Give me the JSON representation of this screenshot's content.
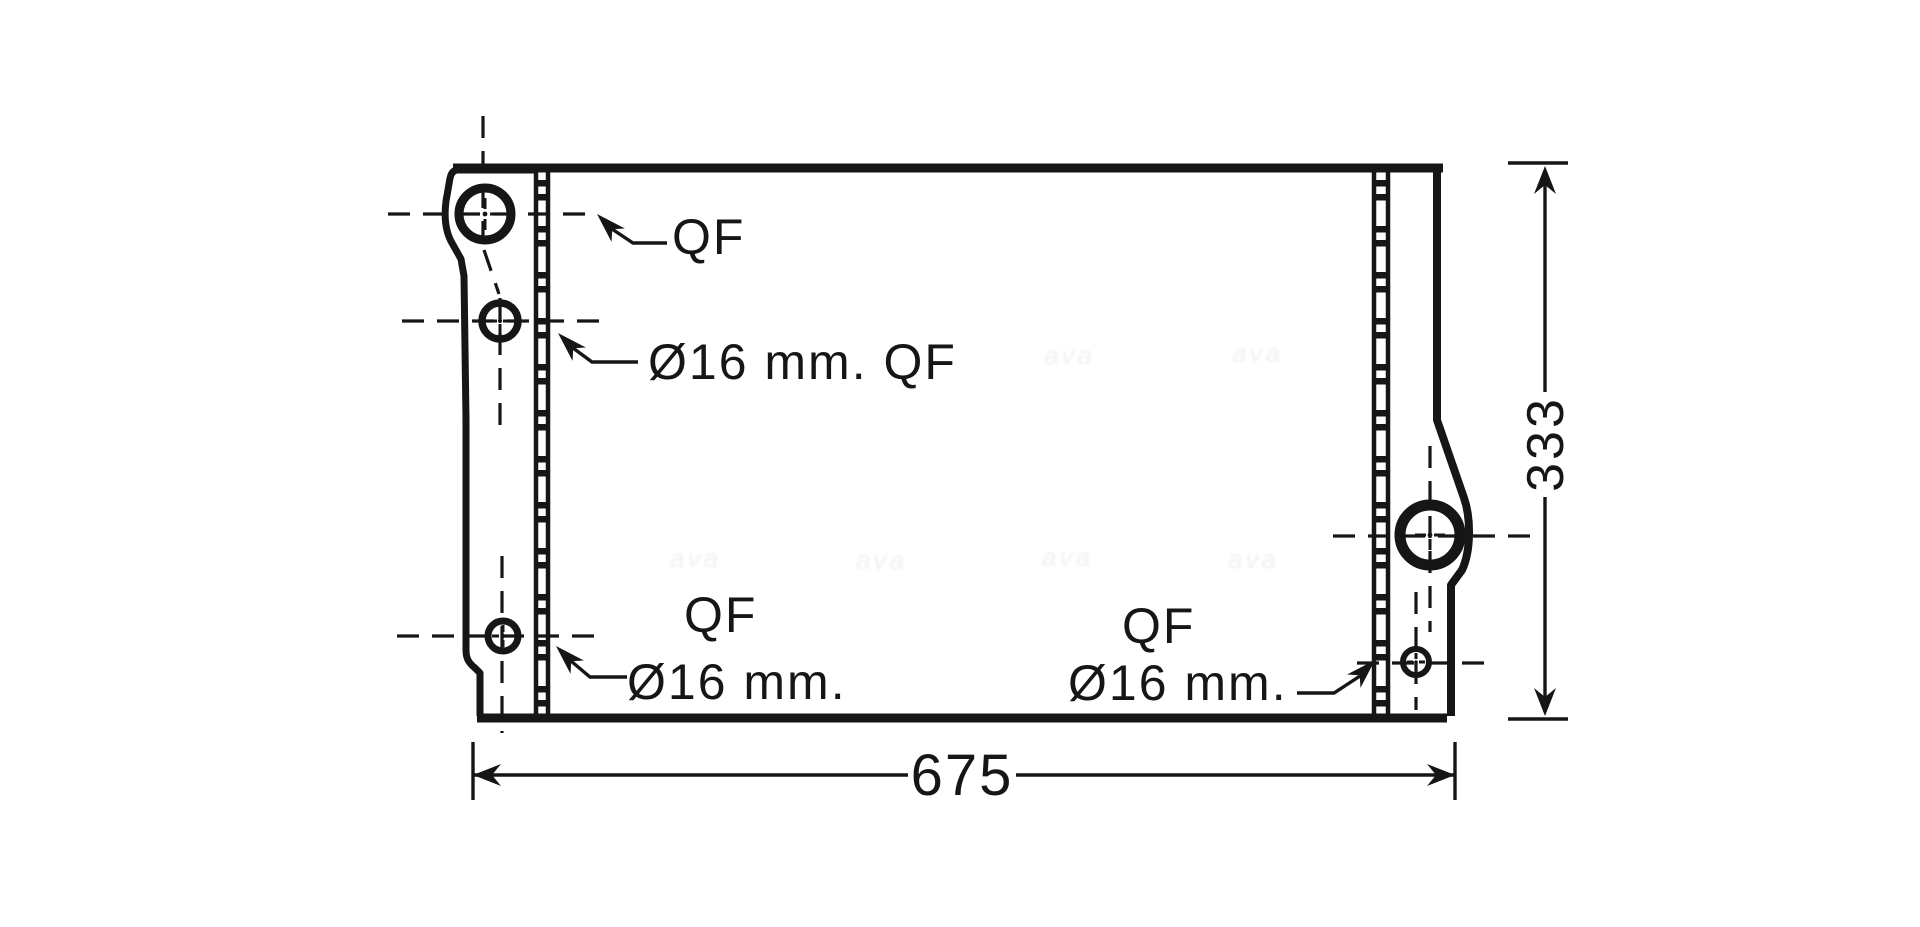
{
  "labels": {
    "callout_top": "QF",
    "callout_upper": "Ø16 mm. QF",
    "callout_lower_left_line1": "QF",
    "callout_lower_left_line2": "Ø16 mm.",
    "callout_lower_right_line1": "QF",
    "callout_lower_right_line2": "Ø16 mm."
  },
  "dimensions": {
    "width": "675",
    "height": "333"
  },
  "watermark": "ava",
  "colors": {
    "line": "#161616",
    "background": "#ffffff"
  }
}
